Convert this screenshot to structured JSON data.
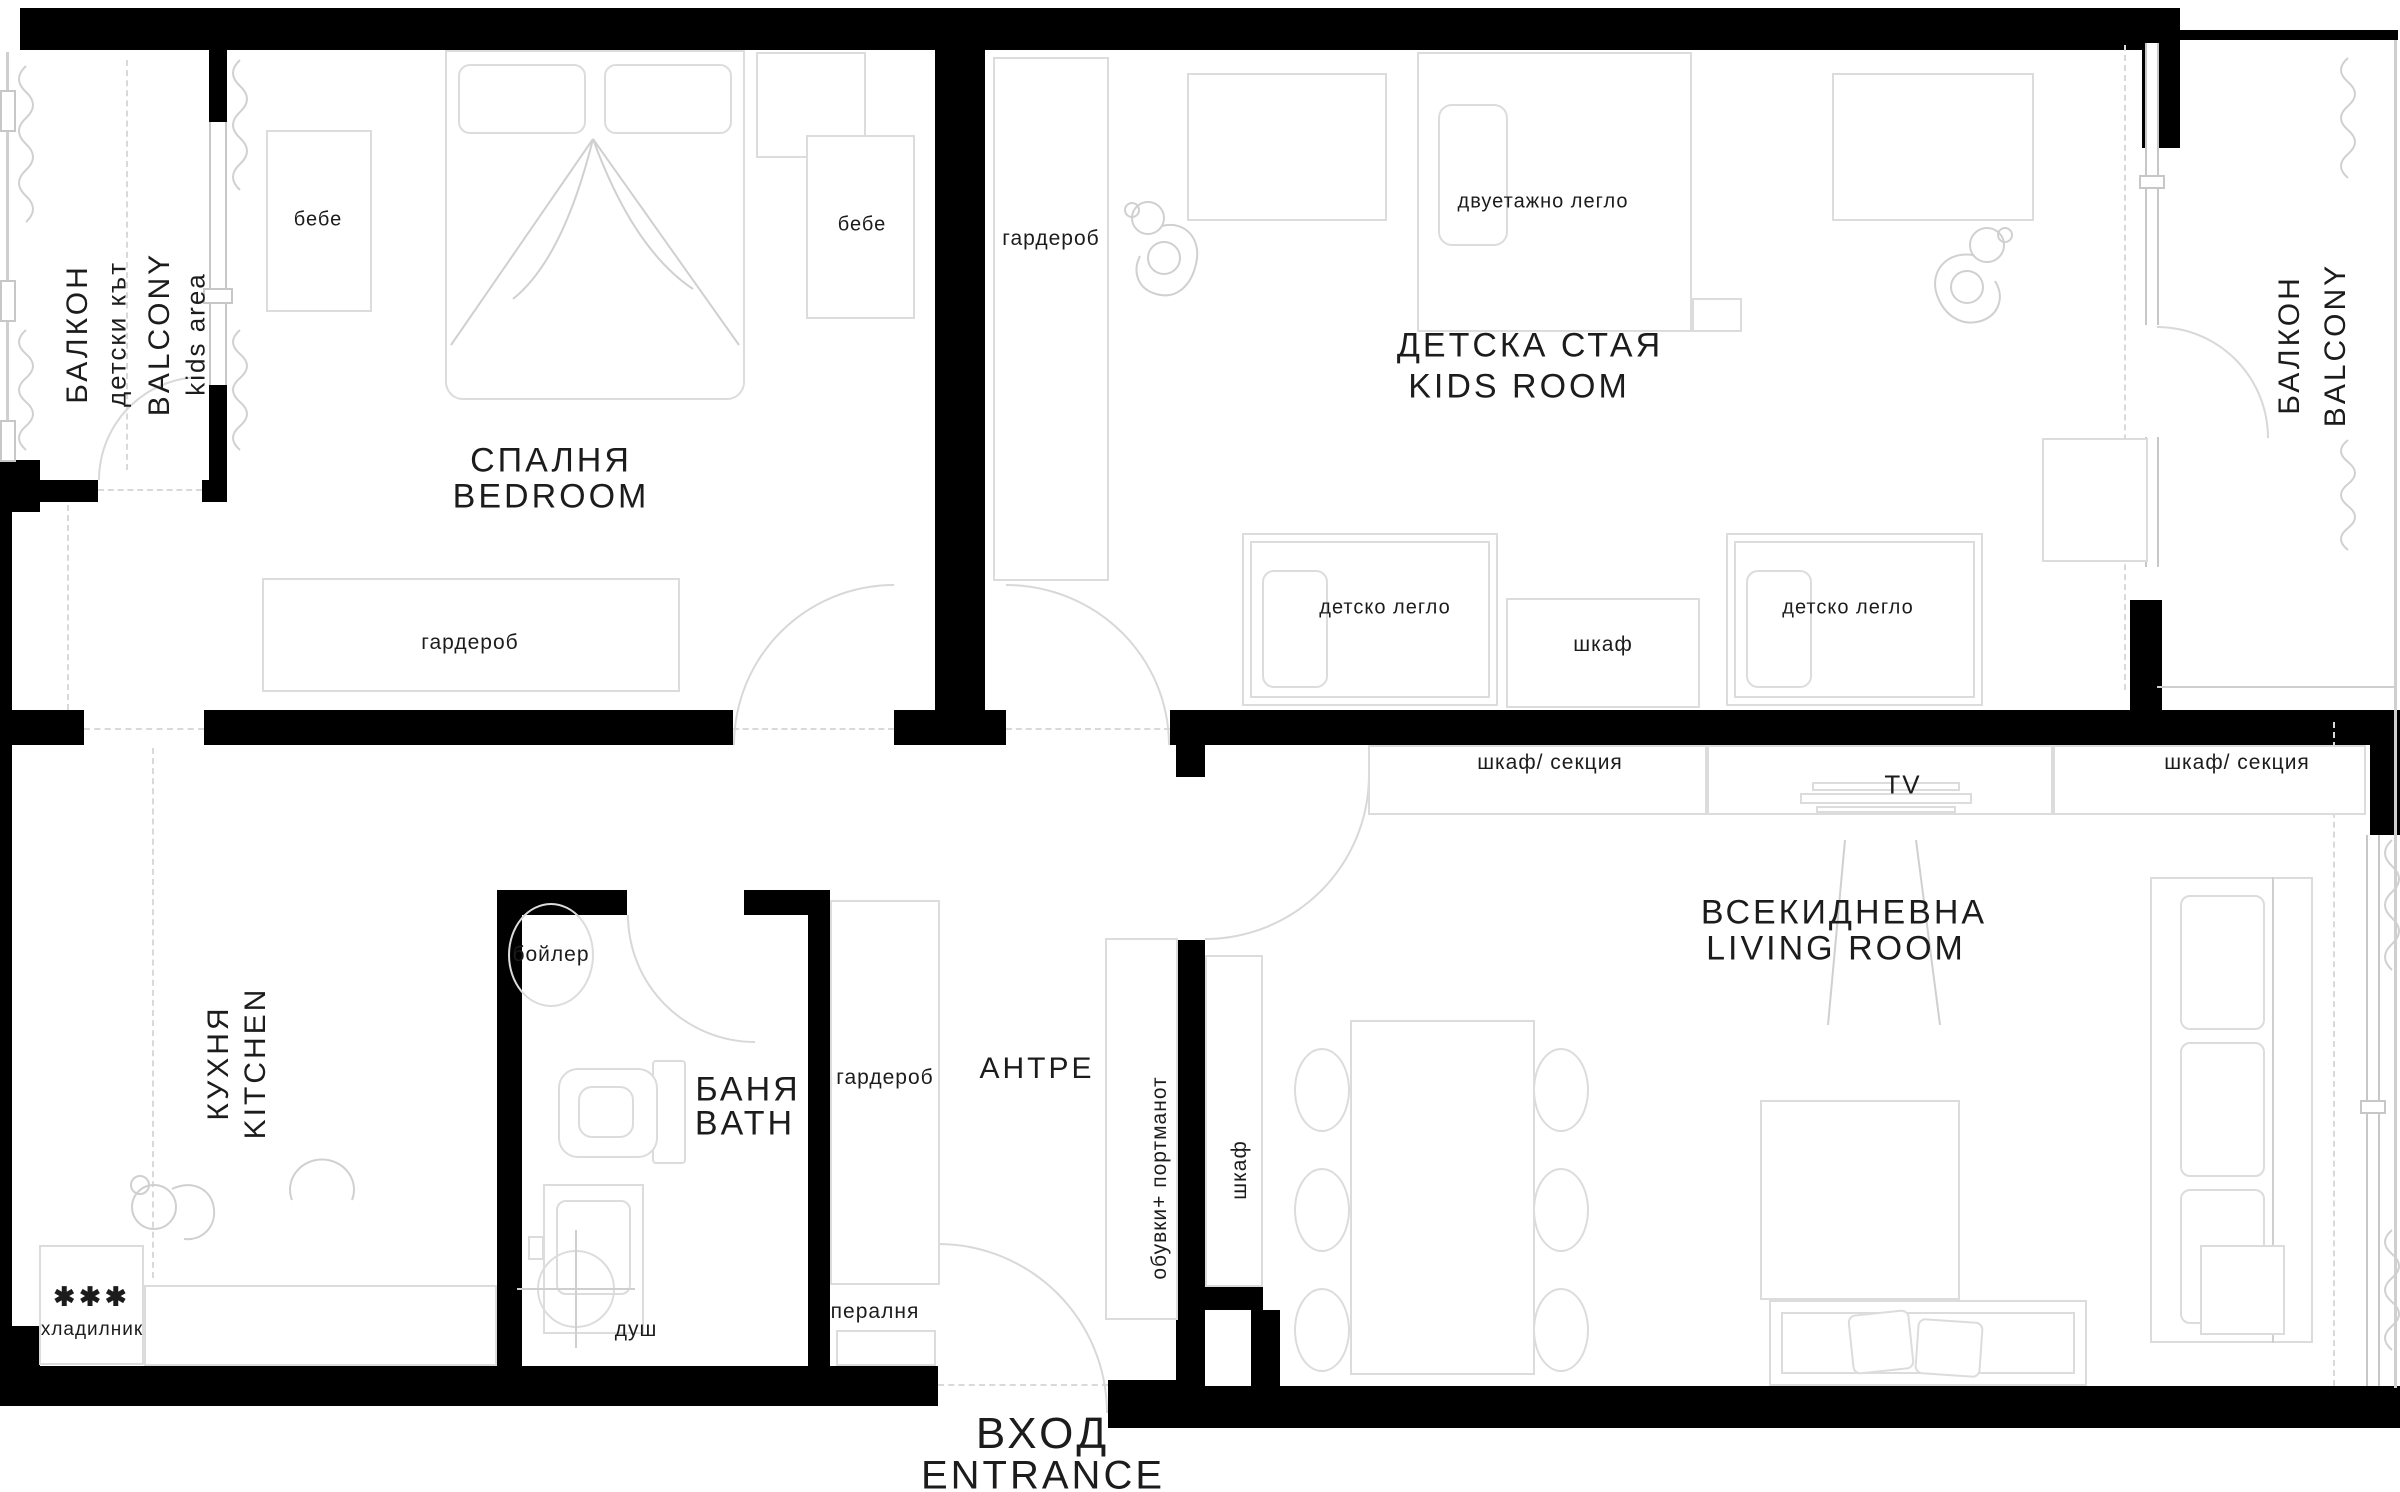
{
  "rooms": {
    "balcony_left": {
      "name_bg": "БАЛКОН",
      "sub_bg": "детски кът",
      "name_en": "BALCONY",
      "sub_en": "kids area"
    },
    "bedroom": {
      "name_bg": "СПАЛНЯ",
      "name_en": "BEDROOM"
    },
    "kids_room": {
      "name_bg": "ДЕТСКА СТАЯ",
      "name_en": "KIDS ROOM"
    },
    "balcony_right": {
      "name_bg": "БАЛКОН",
      "name_en": "BALCONY"
    },
    "living_room": {
      "name_bg": "ВСЕКИДНЕВНА",
      "name_en": "LIVING ROOM"
    },
    "kitchen": {
      "name_bg": "КУХНЯ",
      "name_en": "KITCHEN"
    },
    "bath": {
      "name_bg": "БАНЯ",
      "name_en": "BATH"
    },
    "hall": {
      "name_bg": "АНТРЕ"
    },
    "entrance": {
      "name_bg": "ВХОД",
      "name_en": "ENTRANCE"
    }
  },
  "furniture": {
    "crib_left": "бебе",
    "crib_right": "бебе",
    "wardrobe_bedroom": "гардероб",
    "wardrobe_kids": "гардероб",
    "wardrobe_hall": "гардероб",
    "bunk_bed": "двуетажно легло",
    "kids_bed_left": "детско легло",
    "kids_bed_right": "детско легло",
    "cabinet_kids": "шкаф",
    "cabinet_section_left": "шкаф/ секция",
    "cabinet_section_right": "шкаф/ секция",
    "tv": "TV",
    "shoes_rack": "обувки+ портманот",
    "cabinet_hall": "шкаф",
    "boiler": "бойлер",
    "shower": "душ",
    "washer": "пералня",
    "fridge": "хладилник",
    "fridge_stars": "✱✱✱"
  }
}
